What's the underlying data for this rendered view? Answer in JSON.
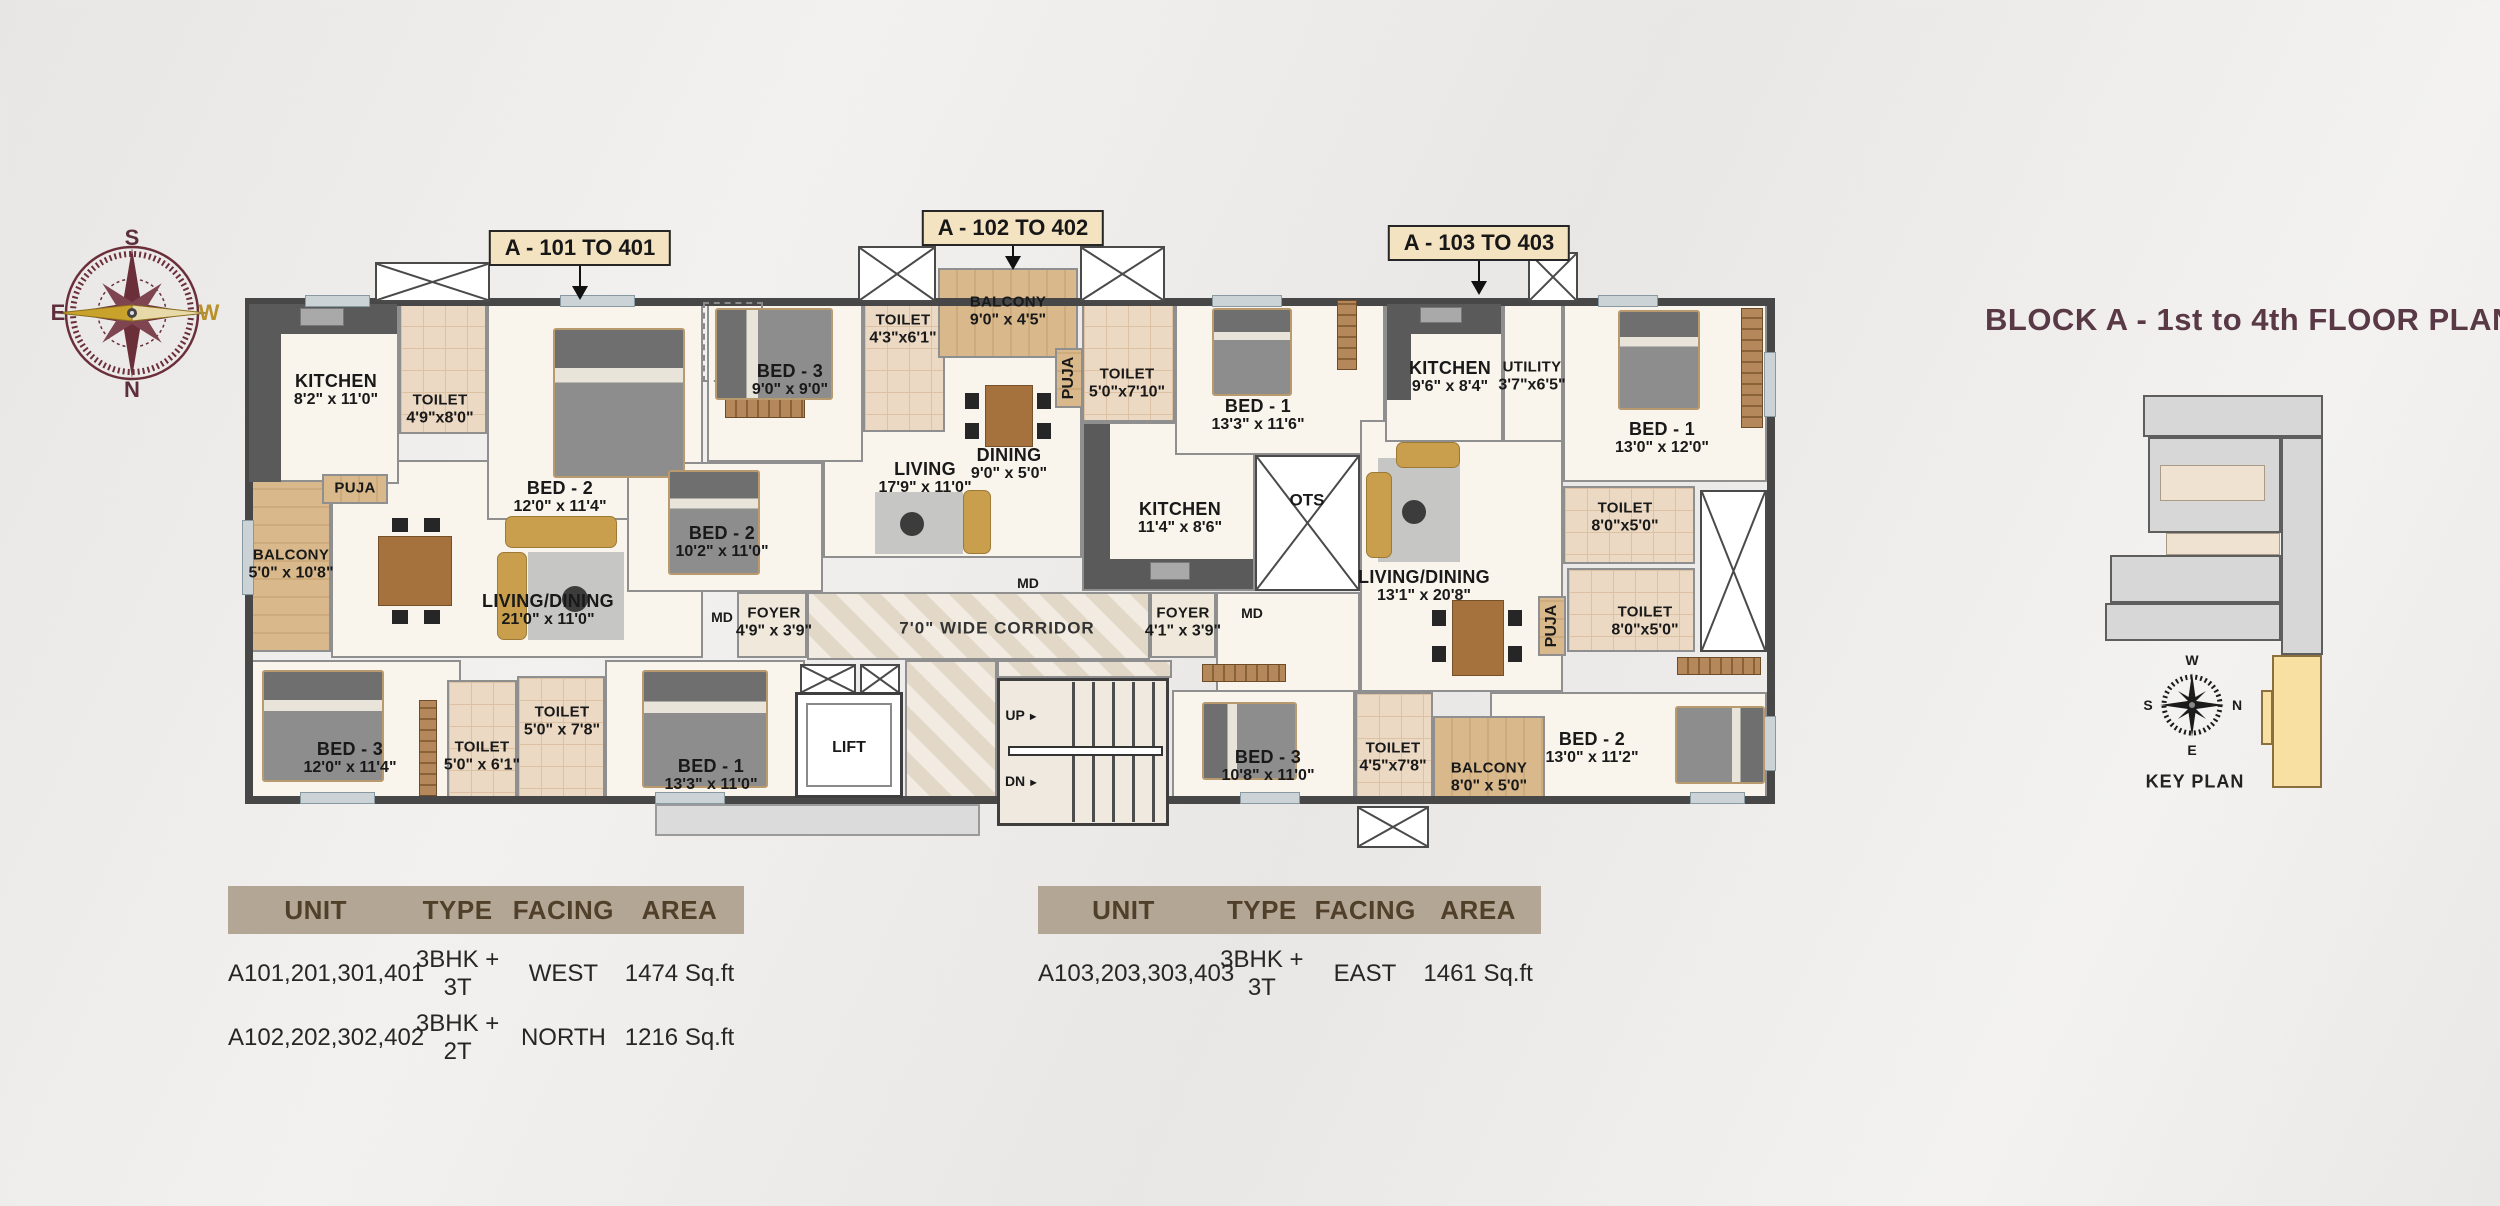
{
  "page": {
    "title": "BLOCK A - 1st to 4th FLOOR PLAN"
  },
  "compass_main": {
    "top": "S",
    "left": "E",
    "right": "W",
    "bottom": "N"
  },
  "unit_callouts": {
    "a101": "A - 101 TO 401",
    "a102": "A - 102 TO 402",
    "a103": "A - 103 TO 403"
  },
  "rooms": {
    "a101_kitchen": {
      "name": "KITCHEN",
      "dims": "8'2\" x 11'0\""
    },
    "a101_toilet_a": {
      "name": "TOILET",
      "dims": "4'9\"x8'0\""
    },
    "a101_bed2": {
      "name": "BED - 2",
      "dims": "12'0\" x 11'4\""
    },
    "a101_puja": {
      "name": "PUJA"
    },
    "a101_balcony": {
      "name": "BALCONY",
      "dims": "5'0\" x 10'8\""
    },
    "a101_living": {
      "name": "LIVING/DINING",
      "dims": "21'0\" x 11'0\""
    },
    "a101_bed3": {
      "name": "BED - 3",
      "dims": "12'0\" x 11'4\""
    },
    "a101_toilet_b": {
      "name": "TOILET",
      "dims": "5'0\" x 6'1\""
    },
    "a101_toilet_c": {
      "name": "TOILET",
      "dims": "5'0\" x 7'8\""
    },
    "a101_bed1": {
      "name": "BED - 1",
      "dims": "13'3\" x 11'0\""
    },
    "a101_foyer": {
      "name": "FOYER",
      "dims": "4'9\" x 3'9\""
    },
    "a102_bed3": {
      "name": "BED - 3",
      "dims": "9'0\" x 9'0\""
    },
    "a102_toilet_a": {
      "name": "TOILET",
      "dims": "4'3\"x6'1\""
    },
    "a102_balcony": {
      "name": "BALCONY",
      "dims": "9'0\" x 4'5\""
    },
    "a102_puja": {
      "name": "PUJA"
    },
    "a102_toilet_b": {
      "name": "TOILET",
      "dims": "5'0\"x7'10\""
    },
    "a102_bed2": {
      "name": "BED - 2",
      "dims": "10'2\" x 11'0\""
    },
    "a102_living": {
      "name": "LIVING",
      "dims": "17'9\" x 11'0\""
    },
    "a102_dining": {
      "name": "DINING",
      "dims": "9'0\" x 5'0\""
    },
    "a102_kitchen": {
      "name": "KITCHEN",
      "dims": "11'4\" x 8'6\""
    },
    "a102_bed1": {
      "name": "BED - 1",
      "dims": "13'3\" x 11'6\""
    },
    "a103_kitchen": {
      "name": "KITCHEN",
      "dims": "9'6\" x 8'4\""
    },
    "a103_utility": {
      "name": "UTILITY",
      "dims": "3'7\"x6'5\""
    },
    "a103_bed1": {
      "name": "BED - 1",
      "dims": "13'0\" x 12'0\""
    },
    "a103_toilet_a": {
      "name": "TOILET",
      "dims": "8'0\"x5'0\""
    },
    "a103_toilet_b": {
      "name": "TOILET",
      "dims": "8'0\"x5'0\""
    },
    "a103_puja": {
      "name": "PUJA"
    },
    "a103_living": {
      "name": "LIVING/DINING",
      "dims": "13'1\" x 20'8\""
    },
    "a103_bed2": {
      "name": "BED - 2",
      "dims": "13'0\" x 11'2\""
    },
    "a103_toilet_c": {
      "name": "TOILET",
      "dims": "4'5\"x7'8\""
    },
    "a103_balcony": {
      "name": "BALCONY",
      "dims": "8'0\" x 5'0\""
    },
    "a103_bed3": {
      "name": "BED - 3",
      "dims": "10'8\" x 11'0\""
    },
    "a103_foyer": {
      "name": "FOYER",
      "dims": "4'1\" x 3'9\""
    }
  },
  "circulation": {
    "corridor": "7'0\" WIDE CORRIDOR",
    "lift": "LIFT",
    "up": "UP",
    "dn": "DN",
    "ots": "OTS",
    "md": "MD"
  },
  "key_plan": {
    "caption": "KEY PLAN",
    "compass": {
      "top": "W",
      "left": "S",
      "right": "N",
      "bottom": "E"
    }
  },
  "area_tables": [
    {
      "headers": [
        "UNIT",
        "TYPE",
        "FACING",
        "AREA"
      ],
      "rows": [
        [
          "A101,201,301,401",
          "3BHK + 3T",
          "WEST",
          "1474 Sq.ft"
        ],
        [
          "A102,202,302,402",
          "3BHK + 2T",
          "NORTH",
          "1216 Sq.ft"
        ]
      ]
    },
    {
      "headers": [
        "UNIT",
        "TYPE",
        "FACING",
        "AREA"
      ],
      "rows": [
        [
          "A103,203,303,403",
          "3BHK + 3T",
          "EAST",
          "1461 Sq.ft"
        ]
      ]
    }
  ],
  "colors": {
    "title": "#5a3947",
    "callout_bg": "#f4e3c1",
    "table_header_bg": "#b3a695",
    "keyplan_highlight": "#f7e0a2"
  }
}
